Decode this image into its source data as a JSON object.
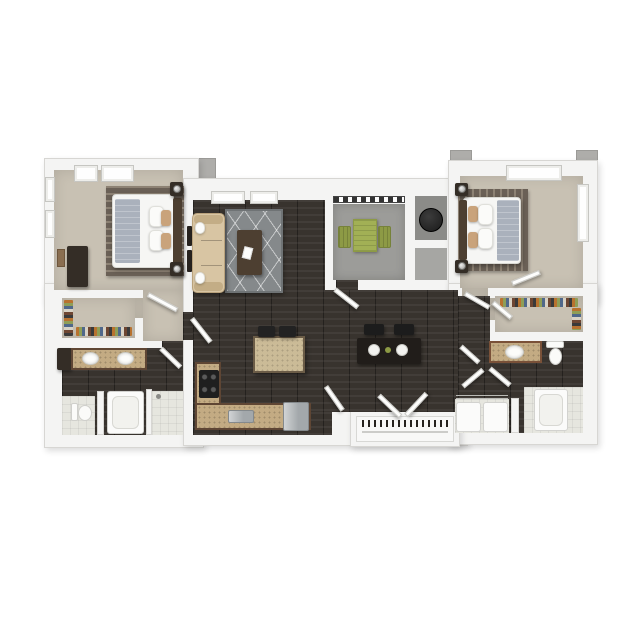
{
  "palette": {
    "background": "#ffffff",
    "wall": "#f4f4f3",
    "wall_edge": "#d7d6d3",
    "extrusion_gray": "#aeadaa",
    "carpet": "#c8c1b3",
    "wood": "#38332e",
    "concrete": "#9c9c99",
    "tile": "#e6e6df",
    "granite": "#c3ab83",
    "cabinet_brown": "#5f4634",
    "island_top": "#cbbb97",
    "sofa": "#d8c5a3",
    "sofa_shadow": "#c3ad86",
    "rug_gray": "#85898b",
    "rug_bed": "#6a6056",
    "rug_bed_stripe": "#8d8274",
    "bed_white": "#f6f6f4",
    "blanket_gray": "#aab1bc",
    "pillow_tan": "#c9a37b",
    "headboard": "#4d3f31",
    "dark_furniture": "#342d26",
    "green": "#a2b055",
    "green_dark": "#8d9a45",
    "water_heater": "#1a1a1a",
    "stainless": "#a3a8ab",
    "stove": "#1f1f1f",
    "fixture_white": "#fbfbfa"
  },
  "floor_plan": {
    "type": "apartment-3d-top-view",
    "rooms": [
      {
        "id": "bedroom-1",
        "floor": "carpet",
        "furniture": [
          "queen-bed",
          "striped-area-rug",
          "nightstand",
          "nightstand",
          "table-lamp",
          "table-lamp",
          "tall-dresser",
          "wall-art"
        ],
        "windows": 4
      },
      {
        "id": "living-room",
        "floor": "dark-hardwood",
        "furniture": [
          "tan-sofa",
          "geometric-gray-rug",
          "coffee-table",
          "magazine",
          "wall-mounted-tv"
        ],
        "windows": 2
      },
      {
        "id": "balcony",
        "floor": "concrete",
        "furniture": [
          "green-bistro-table",
          "patio-chair",
          "patio-chair"
        ],
        "features": [
          "railing",
          "balcony-door"
        ]
      },
      {
        "id": "utility-closet",
        "floor": "gray",
        "furniture": [
          "water-heater"
        ]
      },
      {
        "id": "storage-closet",
        "floor": "gray",
        "furniture": []
      },
      {
        "id": "dining-area",
        "floor": "dark-hardwood",
        "furniture": [
          "dark-dining-table",
          "dining-chair",
          "dining-chair",
          "place-setting",
          "place-setting",
          "centerpiece"
        ]
      },
      {
        "id": "kitchen",
        "floor": "dark-hardwood",
        "furniture": [
          "l-shaped-granite-counter",
          "range-stove",
          "double-sink",
          "refrigerator",
          "kitchen-island",
          "bar-stool",
          "bar-stool"
        ]
      },
      {
        "id": "entry",
        "floor": "dark-hardwood",
        "furniture": [
          "coat-closet-rod"
        ],
        "doors": [
          "entry-door-leaf",
          "entry-door-leaf",
          "interior-door"
        ]
      },
      {
        "id": "hallway",
        "floor": "carpet",
        "furniture": []
      },
      {
        "id": "walk-in-closet-1",
        "floor": "carpet",
        "furniture": [
          "hanging-clothes",
          "hanging-clothes"
        ]
      },
      {
        "id": "bathroom-1",
        "floor": "dark-hardwood",
        "furniture": [
          "double-vanity",
          "sink",
          "sink",
          "linen-cabinet",
          "toilet",
          "bathtub",
          "tiled-shower"
        ]
      },
      {
        "id": "bedroom-2",
        "floor": "carpet",
        "furniture": [
          "queen-bed",
          "striped-area-rug",
          "nightstand",
          "nightstand",
          "table-lamp",
          "table-lamp"
        ],
        "windows": 2
      },
      {
        "id": "walk-in-closet-2",
        "floor": "carpet",
        "furniture": [
          "hanging-clothes",
          "hanging-clothes"
        ]
      },
      {
        "id": "bathroom-2",
        "floor": "dark-hardwood",
        "furniture": [
          "vanity",
          "sink",
          "toilet",
          "bathtub",
          "washer",
          "dryer",
          "wire-shelf"
        ]
      }
    ]
  }
}
